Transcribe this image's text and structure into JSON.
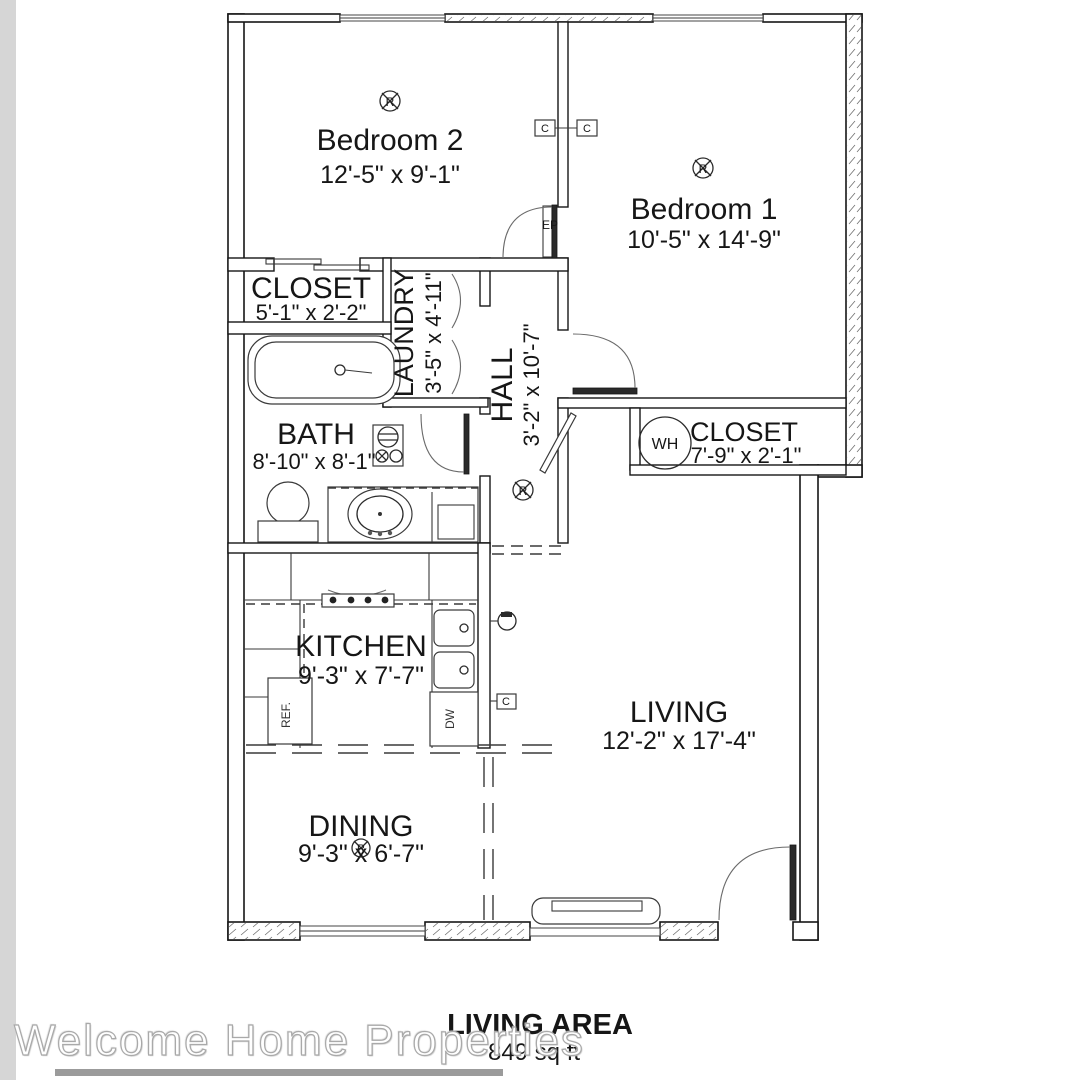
{
  "floorplan": {
    "rooms": {
      "bedroom2": {
        "name": "Bedroom 2",
        "dims": "12'-5\" x 9'-1\""
      },
      "bedroom1": {
        "name": "Bedroom 1",
        "dims": "10'-5\" x 14'-9\""
      },
      "closet_top": {
        "name": "CLOSET",
        "dims": "5'-1\" x 2'-2\""
      },
      "laundry": {
        "name": "LAUNDRY",
        "dims": "3'-5\" x 4'-11\""
      },
      "hall": {
        "name": "HALL",
        "dims": "3'-2\" x 10'-7\""
      },
      "bath": {
        "name": "BATH",
        "dims": "8'-10\" x 8'-1\""
      },
      "closet_wh": {
        "name": "CLOSET",
        "dims": "7'-9\" x 2'-1\""
      },
      "kitchen": {
        "name": "KITCHEN",
        "dims": "9'-3\" x 7'-7\""
      },
      "living": {
        "name": "LIVING",
        "dims": "12'-2\" x 17'-4\""
      },
      "dining": {
        "name": "DINING",
        "dims": "9'-3\" x 6'-7\""
      }
    },
    "fixtures": {
      "refrigerator": "REF.",
      "dishwasher": "DW",
      "water_heater": "WH",
      "electrical_panel": "EP"
    },
    "markers": {
      "ceiling_fixture": "R",
      "circuit": "C"
    },
    "footer": {
      "title": "LIVING AREA",
      "area": "849 sq ft"
    },
    "watermark": "Welcome Home Properties"
  },
  "colors": {
    "wall_line": "#161616",
    "background": "#ffffff",
    "left_strip": "#d6d6d6",
    "watermark_outline": "#a9a9a9",
    "watermark_fill": "#ffffff"
  }
}
